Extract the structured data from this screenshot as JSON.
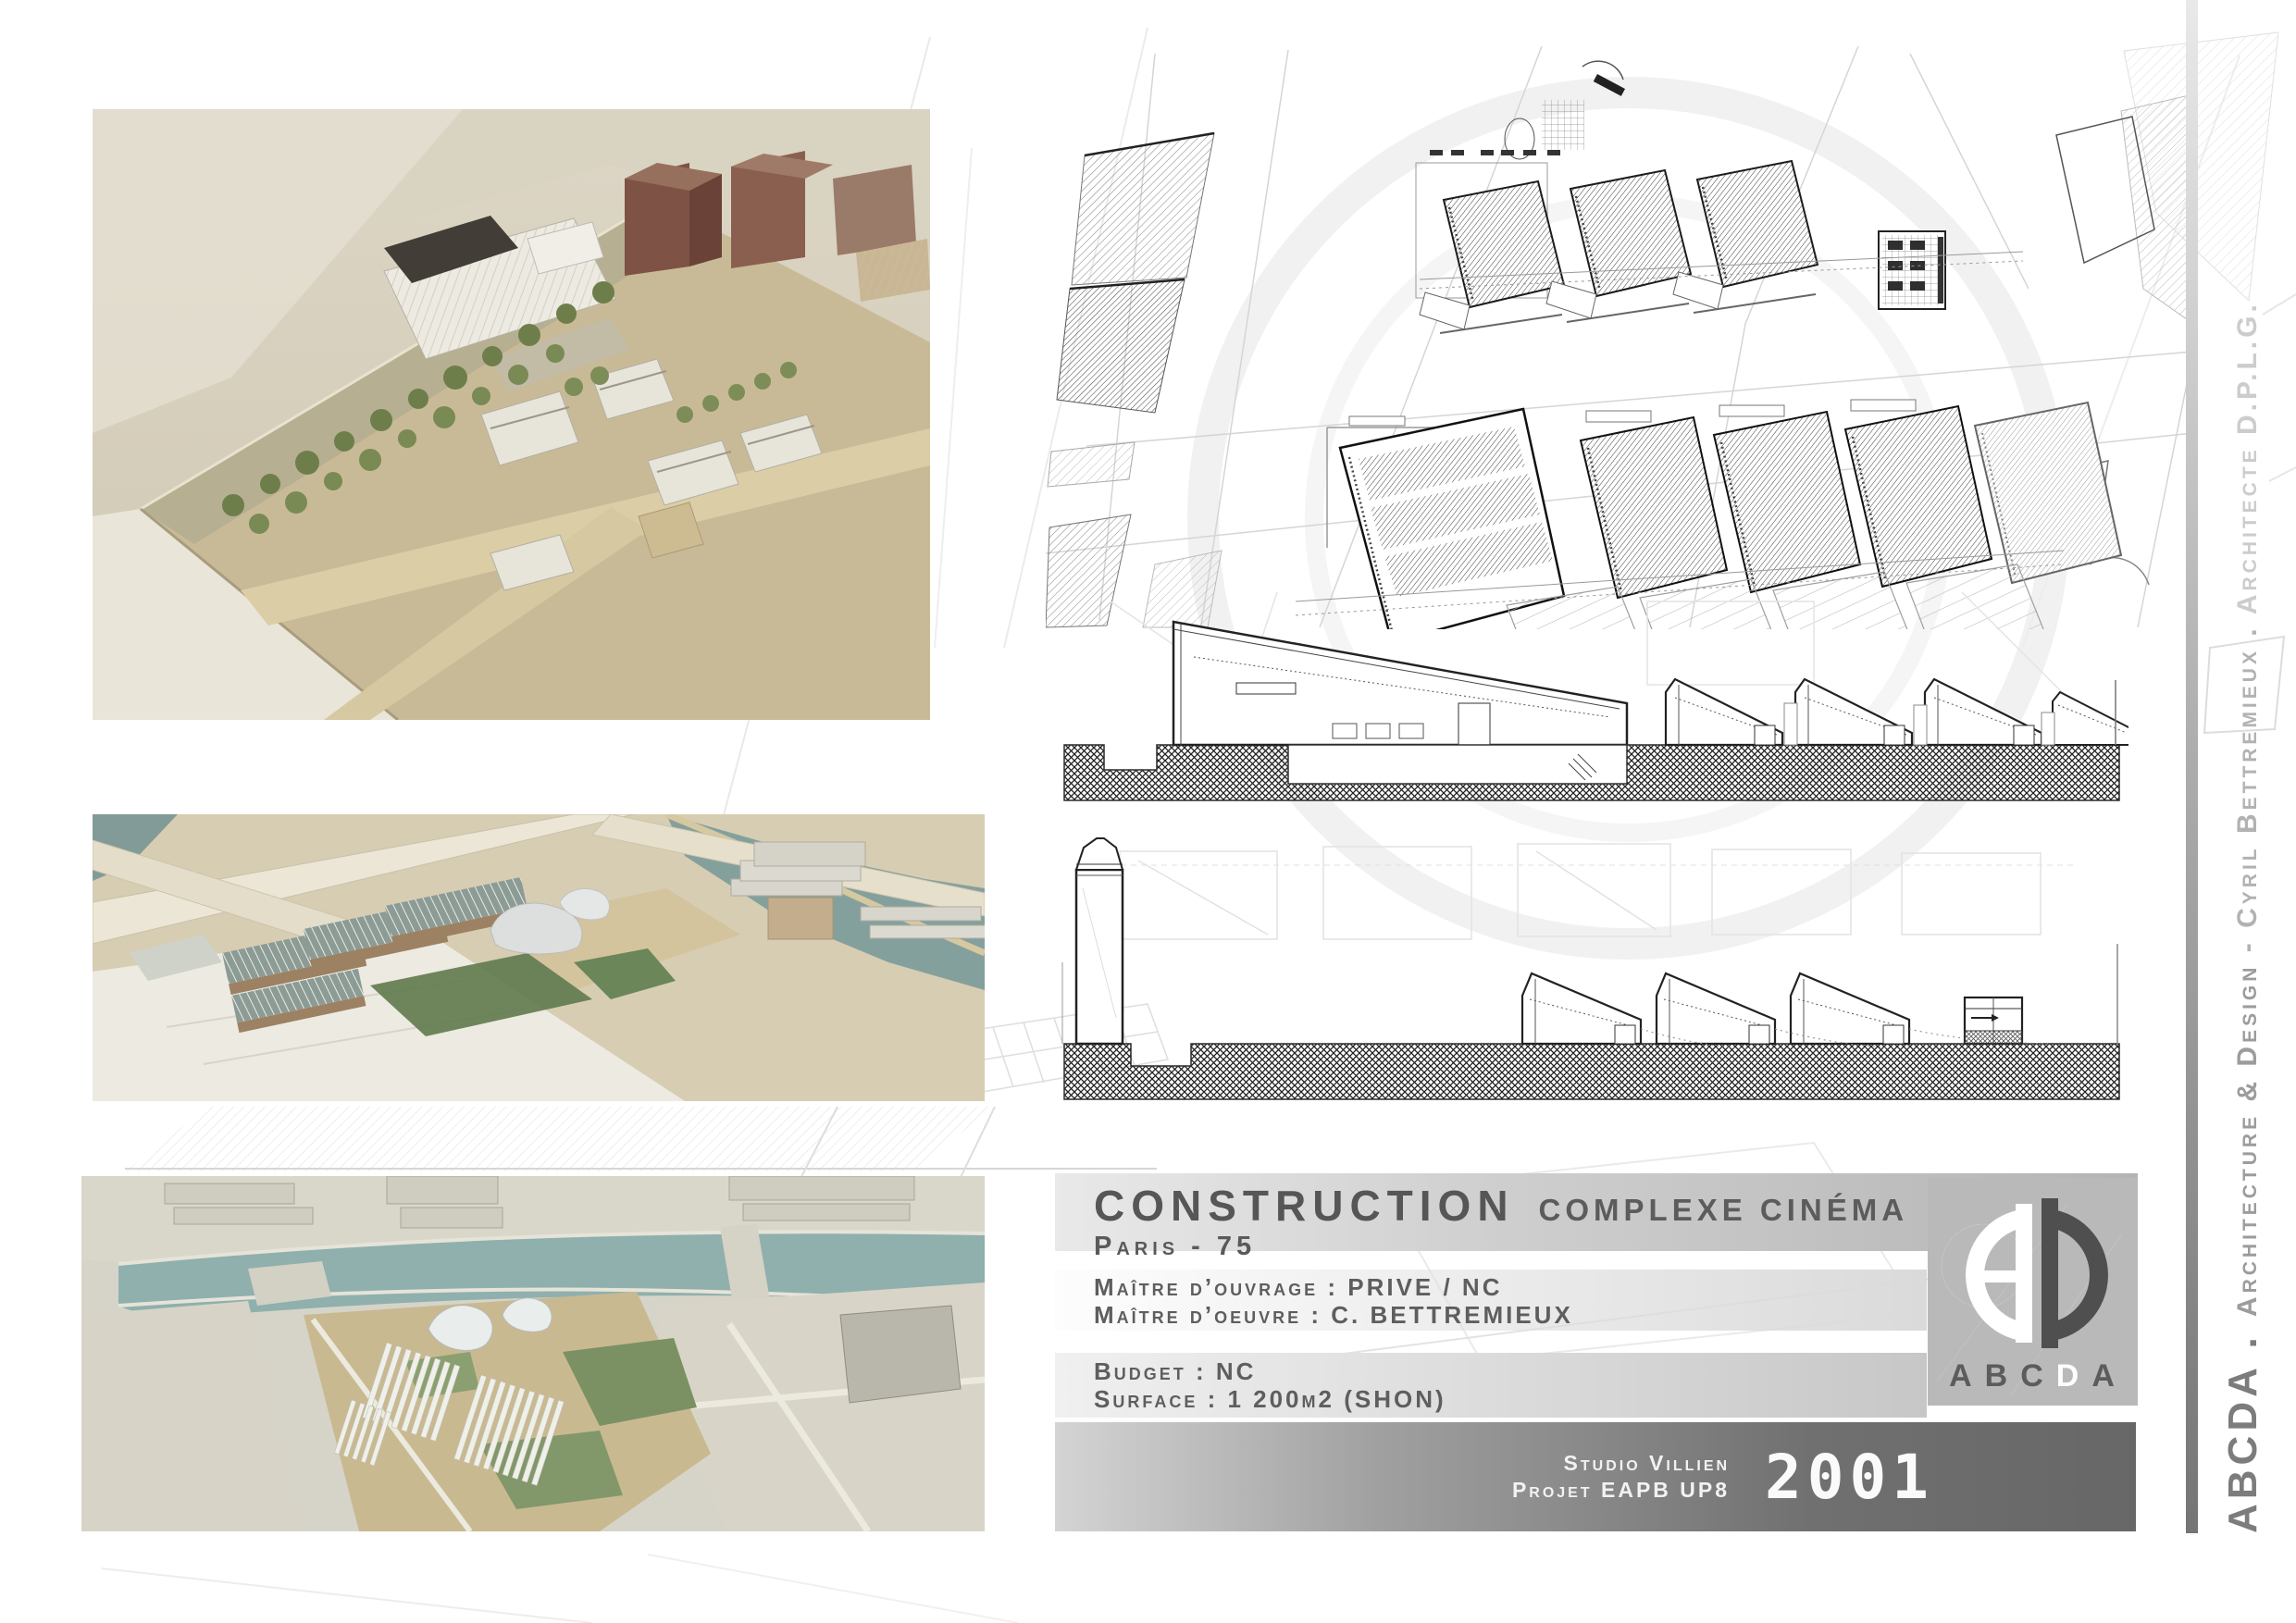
{
  "project": {
    "title": "CONSTRUCTION",
    "subtitle": "COMPLEXE CINÉMA",
    "location": "Paris - 75",
    "maitre_ouvrage": "Maître d’ouvrage : PRIVE / NC",
    "maitre_oeuvre": "Maître d’oeuvre : C. BETTREMIEUX",
    "budget": "Budget : NC",
    "surface": "Surface : 1 200m2 (SHON)"
  },
  "footer": {
    "studio": "Studio Villien",
    "projet": "Projet EAPB UP8",
    "year": "2001"
  },
  "logo": {
    "letters": [
      "A",
      "B",
      "C",
      "D",
      "A"
    ]
  },
  "sidebar": {
    "seg1": "ABCDA . ",
    "seg2": "Architecture & Design ",
    "seg3": "- Cyril Bettremieux . ",
    "seg4": "Architecte D.P.L.G."
  },
  "colors": {
    "band_dark": "#676767",
    "band_light": "#e9e9e9",
    "title_text": "#565656",
    "footer_text": "#f2f2f2",
    "logo_box": "#b9b9b9",
    "logo_dark": "#4f4f4f",
    "logo_white": "#ffffff",
    "river_teal": "#8fb0ad",
    "model_board_tan": "#c9ba97",
    "tree_green": "#6e7e4b",
    "brick_brown": "#8a5f50"
  }
}
